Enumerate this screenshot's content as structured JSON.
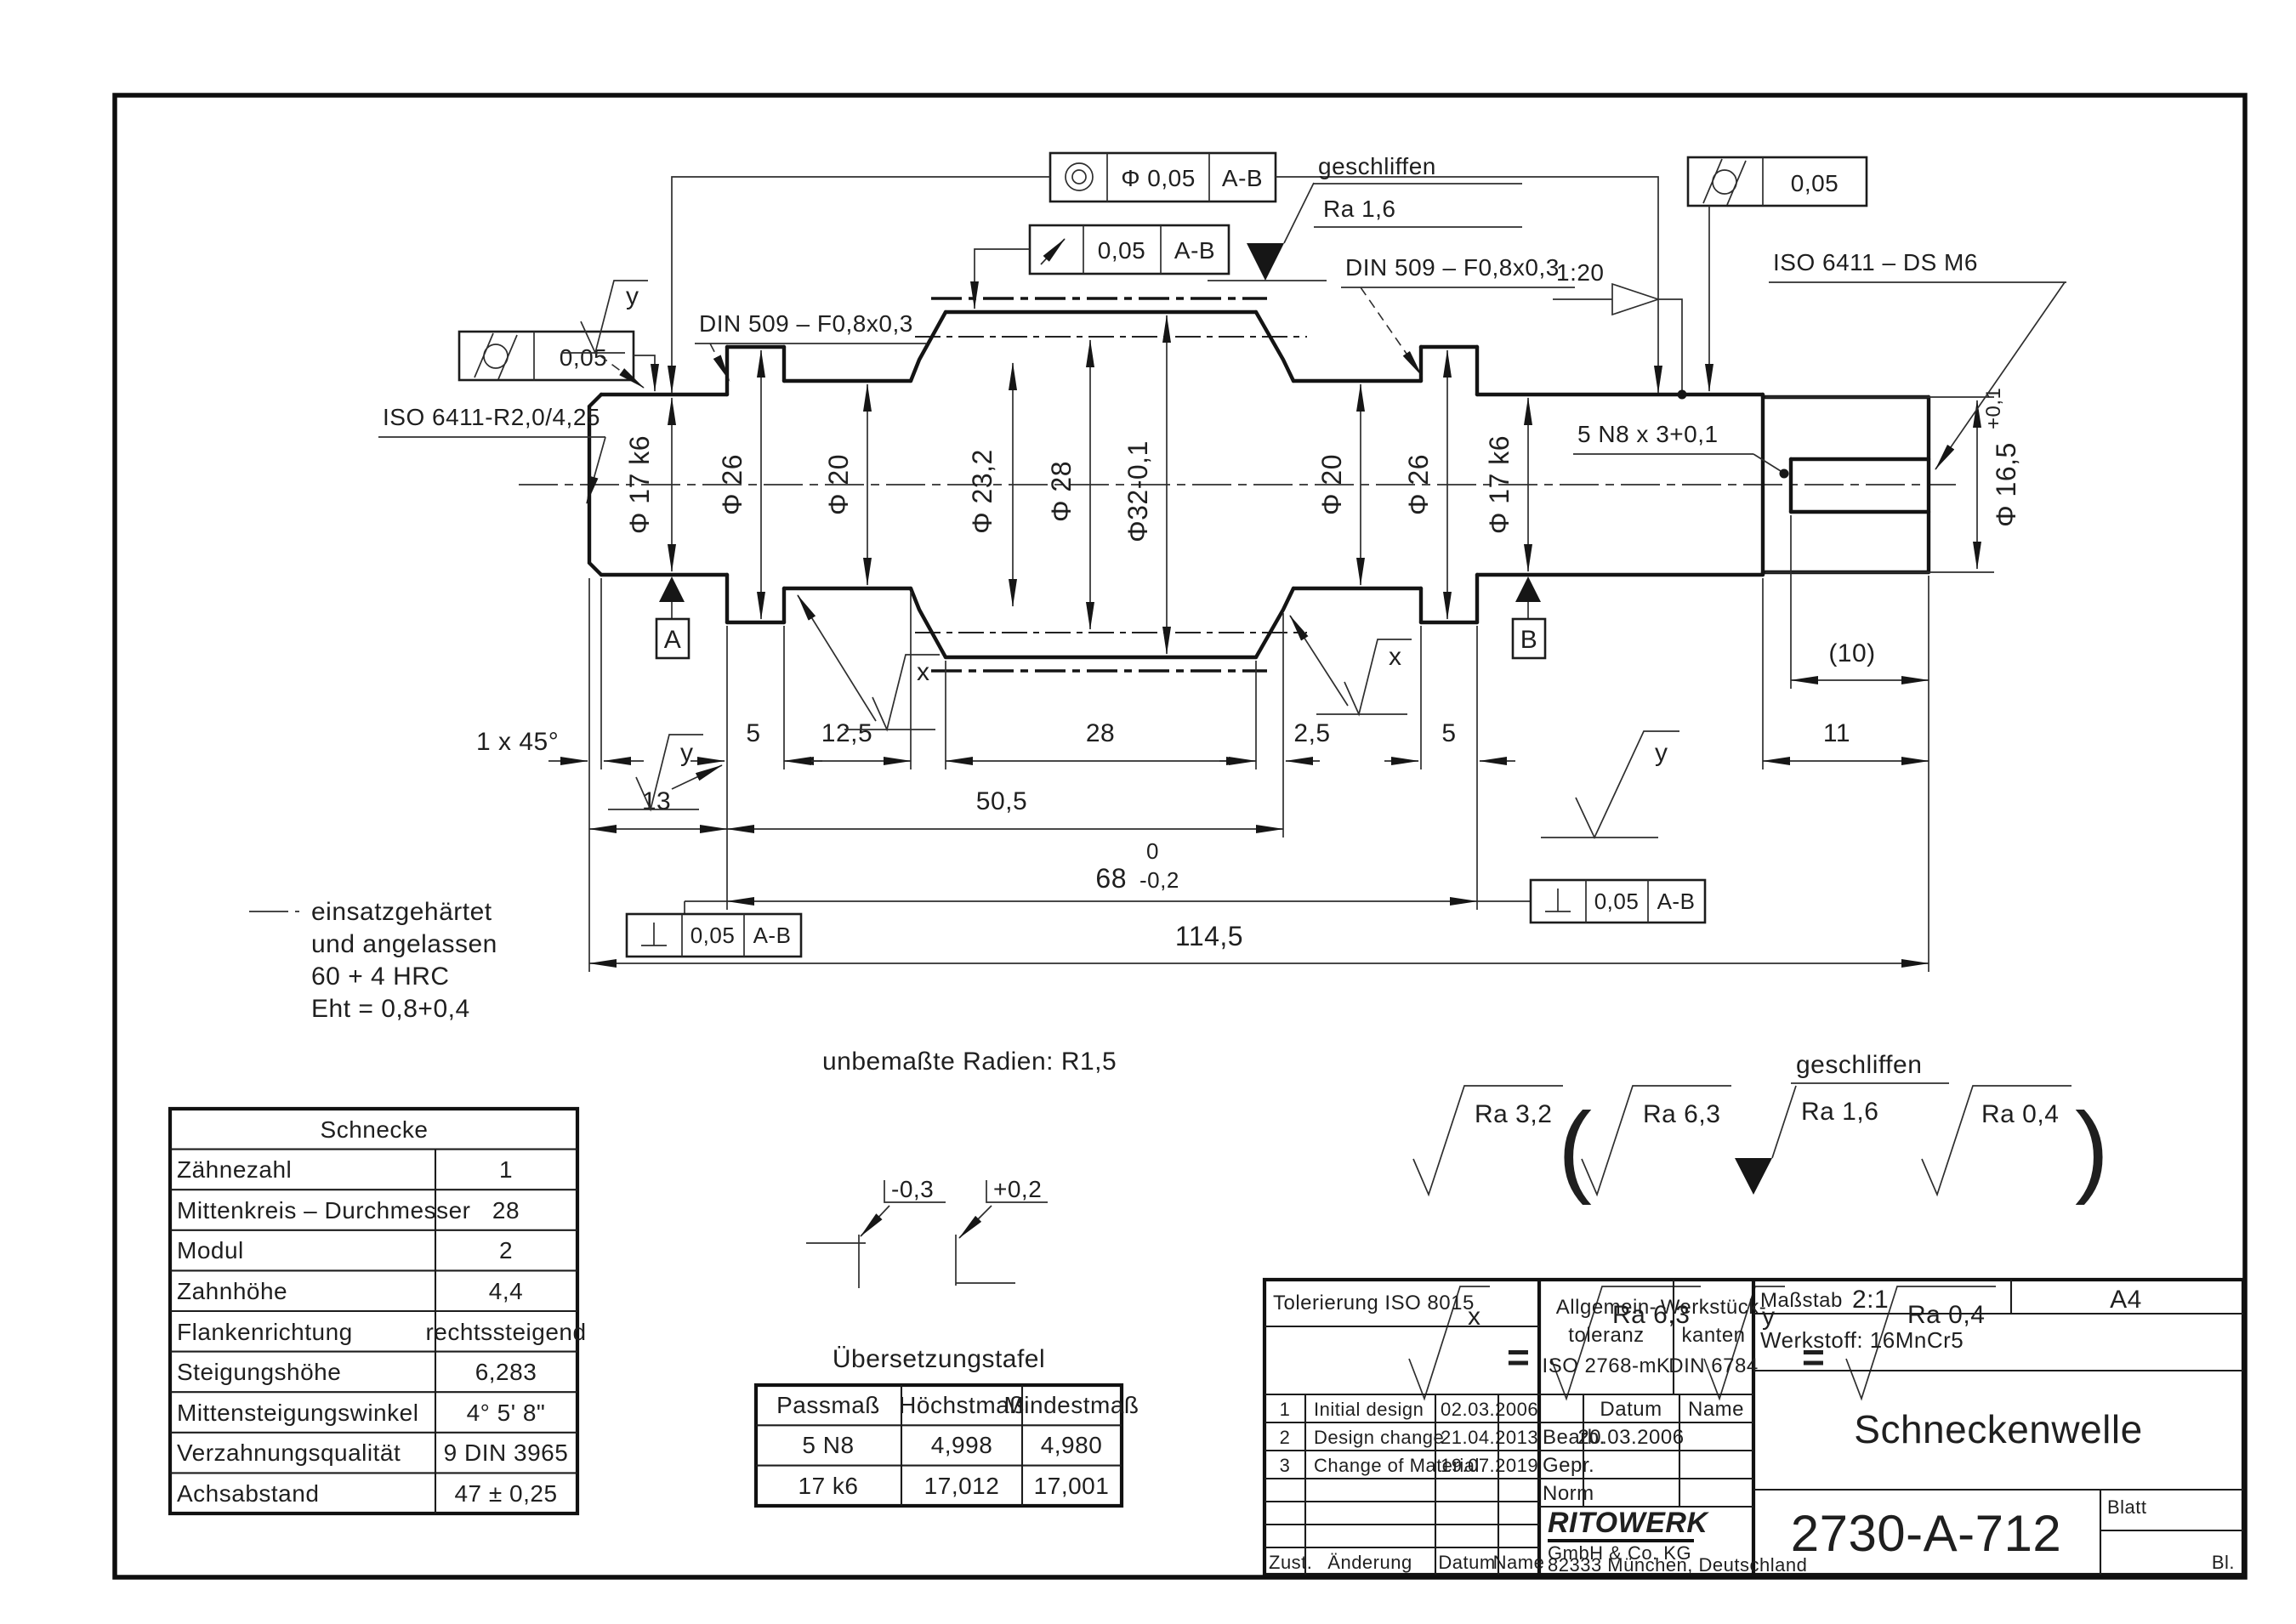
{
  "dims": {
    "diam": [
      "Φ 17 k6",
      "Φ 26",
      "Φ 20",
      "Φ 23,2",
      "Φ 28",
      "Φ32-0,1",
      "Φ 20",
      "Φ 26",
      "Φ 17 k6"
    ],
    "d165": {
      "main": "Φ 16,5",
      "tol": "+0,1"
    },
    "row1": [
      "1 x 45°",
      "5",
      "12,5",
      "28",
      "2,5",
      "5",
      "11"
    ],
    "row2": [
      "13",
      "50,5"
    ],
    "d68": {
      "val": "68",
      "upper": "0",
      "lower": "-0,2"
    },
    "total": "114,5",
    "aux": "(10)",
    "keyway": "5 N8 x 3+0,1"
  },
  "gdt": {
    "concentricity": {
      "dia": "Φ 0,05",
      "ref": "A-B"
    },
    "runout": {
      "tol": "0,05",
      "ref": "A-B"
    },
    "cyl_left": "0,05",
    "cyl_right": "0,05",
    "perp": {
      "tol": "0,05",
      "ref": "A-B"
    },
    "datum_a": "A",
    "datum_b": "B"
  },
  "callouts": {
    "iso6411_left": "ISO 6411-R2,0/4,25",
    "din509_left": "DIN 509 – F0,8x0,3",
    "din509_right": "DIN 509 – F0,8x0,3",
    "iso6411_right": "ISO 6411 – DS M6",
    "taper": "1:20",
    "ground_line1": "geschliffen",
    "ground_line2": "Ra  1,6",
    "surf_x": "x",
    "surf_y": "y"
  },
  "notes": {
    "hardening": [
      "einsatzgehärtet",
      "und angelassen",
      "60 + 4 HRC",
      "Eht = 0,8+0,4"
    ],
    "radii": "unbemaßte Radien: R1,5",
    "edge_minus": "-0,3",
    "edge_plus": "+0,2"
  },
  "schnecke": {
    "title": "Schnecke",
    "rows": [
      {
        "l": "Zähnezahl",
        "v": "1"
      },
      {
        "l": "Mittenkreis – Durchmesser",
        "v": "28"
      },
      {
        "l": "Modul",
        "v": "2"
      },
      {
        "l": "Zahnhöhe",
        "v": "4,4"
      },
      {
        "l": "Flankenrichtung",
        "v": "rechtssteigend"
      },
      {
        "l": "Steigungshöhe",
        "v": "6,283"
      },
      {
        "l": "Mittensteigungswinkel",
        "v": "4° 5' 8\""
      },
      {
        "l": "Verzahnungsqualität",
        "v": "9 DIN 3965"
      },
      {
        "l": "Achsabstand",
        "v": "47 ± 0,25"
      }
    ]
  },
  "uebersetzung": {
    "title": "Übersetzungstafel",
    "head": [
      "Passmaß",
      "Höchstmaß",
      "Mindestmaß"
    ],
    "rows": [
      {
        "a": "5 N8",
        "b": "4,998",
        "c": "4,980"
      },
      {
        "a": "17 k6",
        "b": "17,012",
        "c": "17,001"
      }
    ]
  },
  "legend": {
    "general": "Ra  3,2",
    "open": "(",
    "p1": "Ra  6,3",
    "ground": "geschliffen",
    "p2": "Ra  1,6",
    "p3": "Ra  0,4",
    "close": ")",
    "x": "x",
    "y": "y",
    "eq": "=",
    "xval": "Ra  6,3",
    "yval": "Ra  0,4"
  },
  "titleblock": {
    "tolerierung": "Tolerierung  ISO 8015",
    "allg": [
      "Allgemein-",
      "toleranz",
      "ISO 2768-mK"
    ],
    "kant": [
      "Werkstück-",
      "kanten",
      "DIN 6784"
    ],
    "massstab_label": "Maßstab",
    "massstab_value": "2:1",
    "format": "A4",
    "werkstoff": "Werkstoff: 16MnCr5",
    "header": {
      "datum": "Datum",
      "name": "Name"
    },
    "rows": [
      {
        "nr": "1",
        "text": "Initial design",
        "date": "02.03.2006"
      },
      {
        "nr": "2",
        "text": "Design change",
        "date": "21.04.2013"
      },
      {
        "nr": "3",
        "text": "Change of Material",
        "date": "19.07.2019"
      }
    ],
    "bearb": {
      "label": "Bearb.",
      "date": "20.03.2006"
    },
    "gepr": "Gepr.",
    "norm": "Norm",
    "company": {
      "name": "RITOWERK",
      "line1": "GmbH & Co. KG",
      "line2": "82333 München, Deutschland"
    },
    "part_title": "Schneckenwelle",
    "drawing_no": "2730-A-712",
    "blatt": "Blatt",
    "bl": "Bl.",
    "cols": {
      "zust": "Zust.",
      "aenderung": "Änderung",
      "datum": "Datum",
      "name": "Name"
    }
  }
}
